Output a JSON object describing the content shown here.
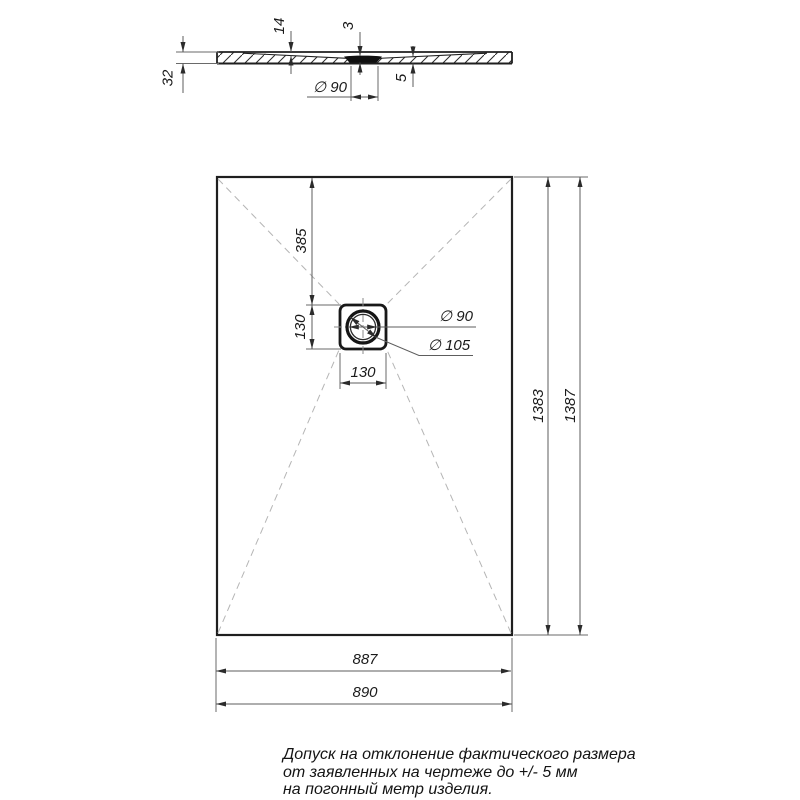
{
  "section": {
    "dim_thickness": "32",
    "dim_basin_depth": "14",
    "dim_recess_depth": "3",
    "dim_min_thickness": "5",
    "dim_drain_diameter": "∅ 90"
  },
  "plan": {
    "dim_top_to_drain": "385",
    "dim_drain_square_v": "130",
    "dim_drain_square_h": "130",
    "dim_drain_d90": "∅ 90",
    "dim_drain_d105": "∅ 105",
    "dim_length_inner": "1383",
    "dim_length_outer": "1387",
    "dim_width_inner": "887",
    "dim_width_outer": "890"
  },
  "note": {
    "line1": "Допуск на отклонение фактического размера",
    "line2": "от заявленных на чертеже до +/- 5 мм",
    "line3": "на погонный метр изделия."
  },
  "colors": {
    "outline": "#1f1f1f",
    "dimension": "#5d5d5d",
    "diagonal": "#b5b5b5",
    "background": "#ffffff"
  }
}
